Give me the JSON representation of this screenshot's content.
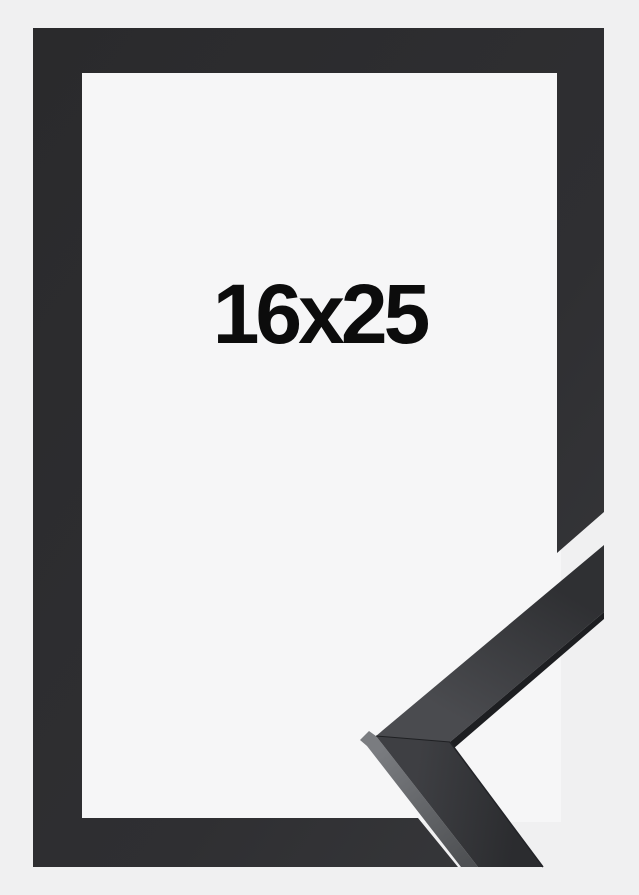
{
  "photo": {
    "size_label": "16x25",
    "subject": "black picture frame with mitered corner sample",
    "frame_orientation": "portrait"
  },
  "colors": {
    "background": "#f0f0f1",
    "mat": "#f6f6f7",
    "frame_dark": "#2a2a2c",
    "frame_light": "#38393c",
    "sample_face_light": "#4a4b4f",
    "sample_face_dark": "#2f3033",
    "sample_side_light": "#7a7c80",
    "sample_side_dark": "#4e5053",
    "sample_edge": "#1d1e21",
    "label_text": "#0c0c0c"
  }
}
